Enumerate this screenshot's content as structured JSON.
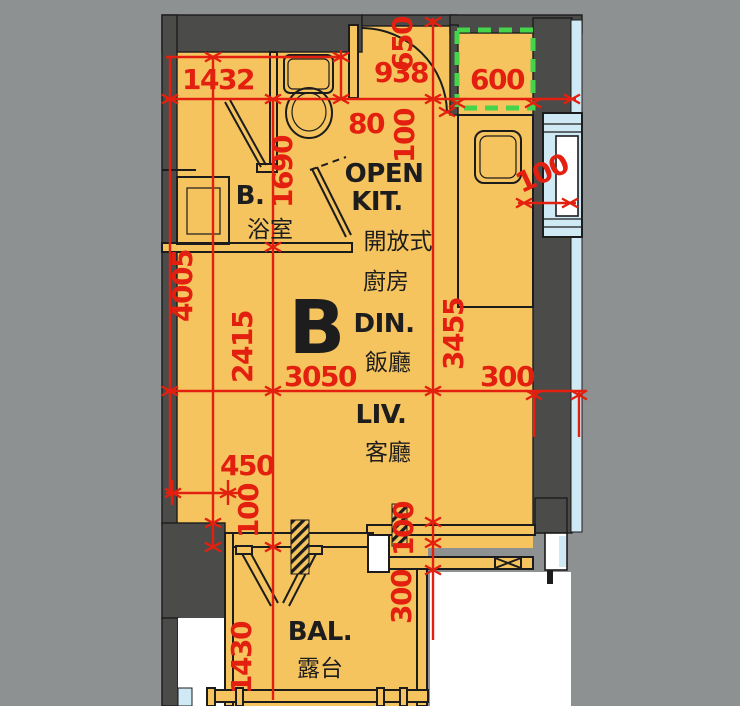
{
  "title": "Unit B floor plan",
  "unit": {
    "label": "B"
  },
  "rooms": {
    "bathroom": {
      "abbr": "B.",
      "zh": "浴室"
    },
    "kitchen": {
      "en1": "OPEN",
      "en2": "KIT.",
      "zh1": "開放式",
      "zh2": "廚房"
    },
    "dining": {
      "en": "DIN.",
      "zh": "飯廳"
    },
    "living": {
      "en": "LIV.",
      "zh": "客廳"
    },
    "balcony": {
      "en": "BAL.",
      "zh": "露台"
    }
  },
  "dims": {
    "bath_width": "1432",
    "entry_width": "938",
    "entry_depth": "650",
    "ac_plinth": "600",
    "gap_80": "80",
    "door_side_100": "100",
    "bath_depth": "1690",
    "kitchen_wall_100": "100",
    "left_height": "4005",
    "mid_height": "2415",
    "room_width": "3050",
    "right_height": "3455",
    "right_wall_300": "300",
    "notch_450": "450",
    "notch_100": "100",
    "bal_wall_100": "100",
    "bal_wall_300": "300",
    "balcony_depth": "1430"
  },
  "colors": {
    "background": "#8e9192",
    "floor": "#f6c45e",
    "wall": "#4b4b4a",
    "dimension": "#e3200f",
    "glazing": "#cfe9f5",
    "ac_dashed": "#44d54b"
  }
}
